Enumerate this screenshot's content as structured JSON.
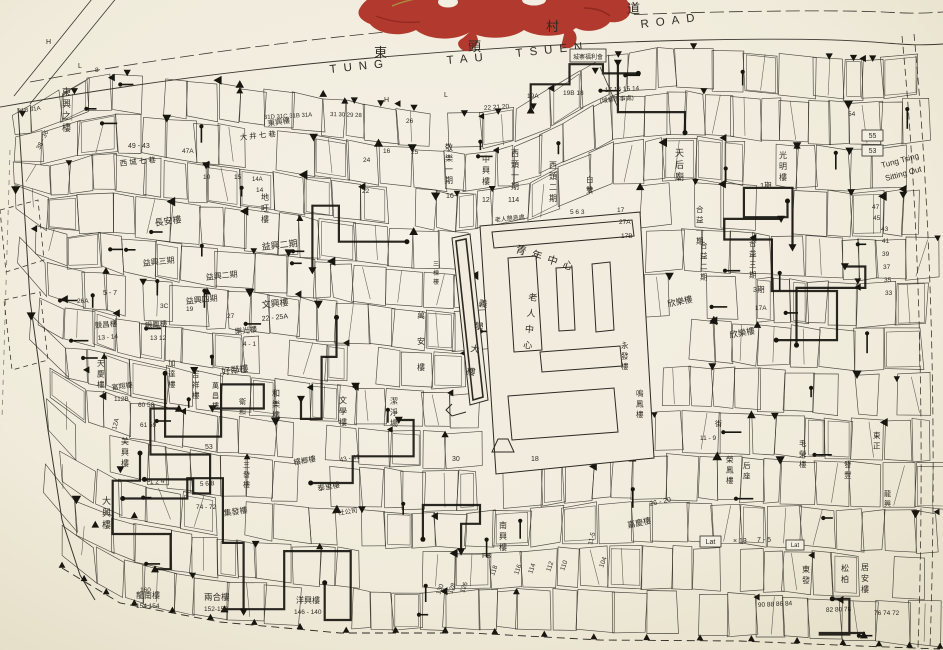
{
  "map": {
    "colors": {
      "paper": "#f2eee1",
      "paper_edge": "#e6dfca",
      "ink": "#2e2b24",
      "ink_heavy": "#17150f",
      "seal_red": "#b2392e",
      "seal_gold": "#a98f3e"
    },
    "road": {
      "name_zh": "東頭村道",
      "name_en": "TUNG TAU TSUEN ROAD",
      "zh": [
        {
          "t": "東",
          "x": 374,
          "y": 57
        },
        {
          "t": "頭",
          "x": 468,
          "y": 51
        },
        {
          "t": "村",
          "x": 546,
          "y": 31
        },
        {
          "t": "道",
          "x": 627,
          "y": 13
        }
      ],
      "en": [
        {
          "t": "TUNG",
          "x": 330,
          "y": 73,
          "rot": -6,
          "ls": 7
        },
        {
          "t": "TAU",
          "x": 447,
          "y": 64,
          "rot": -5,
          "ls": 7
        },
        {
          "t": "TSUEN",
          "x": 516,
          "y": 57,
          "rot": -6,
          "ls": 7
        },
        {
          "t": "ROAD",
          "x": 641,
          "y": 28,
          "rot": -7,
          "ls": 7
        }
      ]
    },
    "corner_note": {
      "line1": "Tung Tsing",
      "line2": "Sitting Out"
    },
    "boxes": [
      {
        "t": "城寨福利會",
        "x": 570,
        "y": 49,
        "w": 36,
        "h": 13,
        "fs": 6
      },
      {
        "t": "55",
        "x": 862,
        "y": 130,
        "w": 21,
        "h": 11,
        "fs": 7
      },
      {
        "t": "53",
        "x": 862,
        "y": 145,
        "w": 21,
        "h": 11,
        "fs": 7
      },
      {
        "t": "Lat",
        "x": 700,
        "y": 536,
        "w": 21,
        "h": 11,
        "fs": 7
      },
      {
        "t": "Lat",
        "x": 786,
        "y": 540,
        "w": 18,
        "h": 10,
        "fs": 6
      }
    ],
    "labels": [
      {
        "t": "東興之樓",
        "x": 62,
        "y": 95,
        "fs": 9,
        "v": 1
      },
      {
        "t": "長安樓",
        "x": 155,
        "y": 226,
        "fs": 9,
        "rot": -8
      },
      {
        "t": "地旺樓",
        "x": 261,
        "y": 200,
        "fs": 8,
        "v": 1
      },
      {
        "t": "益興二期",
        "x": 262,
        "y": 250,
        "fs": 9,
        "rot": -6
      },
      {
        "t": "益興三期",
        "x": 143,
        "y": 266,
        "fs": 8,
        "rot": -6
      },
      {
        "t": "益興二期",
        "x": 206,
        "y": 280,
        "fs": 8,
        "rot": -6
      },
      {
        "t": "益興四期",
        "x": 186,
        "y": 304,
        "fs": 8,
        "rot": -6
      },
      {
        "t": "文興樓",
        "x": 262,
        "y": 308,
        "fs": 9,
        "rot": -6
      },
      {
        "t": "22 - 25A",
        "x": 262,
        "y": 321,
        "fs": 7,
        "rot": -6,
        "n": 1
      },
      {
        "t": "競昌樓",
        "x": 95,
        "y": 328,
        "fs": 7.5,
        "rot": -5
      },
      {
        "t": "13 - 14",
        "x": 98,
        "y": 340,
        "fs": 6.5,
        "rot": -5,
        "n": 1
      },
      {
        "t": "銀鳳樓",
        "x": 145,
        "y": 328,
        "fs": 7.5,
        "rot": -5
      },
      {
        "t": "13  12",
        "x": 150,
        "y": 340,
        "fs": 6.5,
        "n": 1
      },
      {
        "t": "樂光樓",
        "x": 235,
        "y": 334,
        "fs": 7.5,
        "rot": -6
      },
      {
        "t": "4 - 1",
        "x": 243,
        "y": 346,
        "fs": 6.5,
        "n": 1
      },
      {
        "t": "好鄰樓",
        "x": 222,
        "y": 375,
        "fs": 9,
        "rot": -8
      },
      {
        "t": "萬昌樓",
        "x": 212,
        "y": 388,
        "fs": 7,
        "v": 1
      },
      {
        "t": "衛和",
        "x": 239,
        "y": 404,
        "fs": 7,
        "v": 1
      },
      {
        "t": "和樂樓",
        "x": 272,
        "y": 396,
        "fs": 8,
        "v": 1
      },
      {
        "t": "文學樓",
        "x": 339,
        "y": 403,
        "fs": 8,
        "v": 1
      },
      {
        "t": "萬安樓",
        "x": 417,
        "y": 318,
        "fs": 8,
        "v": 1,
        "vs": 26
      },
      {
        "t": "義學大樓",
        "x": 478,
        "y": 306,
        "fs": 9,
        "v": 1,
        "vs": 23,
        "rot": 10
      },
      {
        "t": "三棟樓",
        "x": 433,
        "y": 266,
        "fs": 6,
        "v": 1
      },
      {
        "t": "潔淨場",
        "x": 390,
        "y": 404,
        "fs": 8,
        "v": 1
      },
      {
        "t": "青年中心",
        "x": 515,
        "y": 252,
        "fs": 10.5,
        "rot": 18,
        "ls": 6
      },
      {
        "t": "老人中心",
        "x": 528,
        "y": 300,
        "fs": 9,
        "v": 1,
        "vs": 16,
        "rot": 6
      },
      {
        "t": "老人憩息處",
        "x": 495,
        "y": 222,
        "fs": 6,
        "rot": -6
      },
      {
        "t": "天后廟",
        "x": 675,
        "y": 156,
        "fs": 9,
        "v": 1
      },
      {
        "t": "合益一期",
        "x": 696,
        "y": 212,
        "fs": 7.5,
        "v": 1
      },
      {
        "t": "合益二期",
        "x": 700,
        "y": 248,
        "fs": 7.5,
        "v": 1
      },
      {
        "t": "合益三期",
        "x": 749,
        "y": 246,
        "fs": 7.5,
        "v": 1
      },
      {
        "t": "1期",
        "x": 760,
        "y": 188,
        "fs": 7.5
      },
      {
        "t": "3期",
        "x": 753,
        "y": 292,
        "fs": 7.5
      },
      {
        "t": "17A",
        "x": 755,
        "y": 310,
        "fs": 6.5,
        "n": 1
      },
      {
        "t": "欣樂樓",
        "x": 668,
        "y": 307,
        "fs": 8.5,
        "rot": -12
      },
      {
        "t": "欣樂樓",
        "x": 730,
        "y": 338,
        "fs": 8.5,
        "rot": -10
      },
      {
        "t": "光明樓",
        "x": 779,
        "y": 158,
        "fs": 8,
        "v": 1
      },
      {
        "t": "白雙",
        "x": 586,
        "y": 182,
        "fs": 7.5,
        "v": 1
      },
      {
        "t": "敬樂一期",
        "x": 445,
        "y": 150,
        "fs": 8,
        "v": 1
      },
      {
        "t": "16",
        "x": 446,
        "y": 198,
        "fs": 7,
        "n": 1
      },
      {
        "t": "中興樓",
        "x": 482,
        "y": 162,
        "fs": 8,
        "v": 1
      },
      {
        "t": "12",
        "x": 482,
        "y": 202,
        "fs": 7,
        "n": 1
      },
      {
        "t": "西頭一期",
        "x": 511,
        "y": 156,
        "fs": 8,
        "v": 1
      },
      {
        "t": "114",
        "x": 508,
        "y": 202,
        "fs": 7,
        "n": 1
      },
      {
        "t": "西頭二期",
        "x": 549,
        "y": 168,
        "fs": 8,
        "v": 1
      },
      {
        "t": "鳴鳳樓",
        "x": 636,
        "y": 396,
        "fs": 7.5,
        "v": 1
      },
      {
        "t": "永發樓",
        "x": 621,
        "y": 348,
        "fs": 7.5,
        "v": 1
      },
      {
        "t": "嘉慶樓",
        "x": 628,
        "y": 528,
        "fs": 8,
        "rot": -12
      },
      {
        "t": "26 - 20",
        "x": 650,
        "y": 506,
        "fs": 7,
        "rot": -12,
        "n": 1
      },
      {
        "t": "榮鳳樓",
        "x": 726,
        "y": 462,
        "fs": 7.5,
        "v": 1
      },
      {
        "t": "后座",
        "x": 743,
        "y": 468,
        "fs": 7.5,
        "v": 1
      },
      {
        "t": "毛榮樓",
        "x": 799,
        "y": 446,
        "fs": 7.5,
        "v": 1
      },
      {
        "t": "發豐",
        "x": 844,
        "y": 467,
        "fs": 7.5,
        "v": 1
      },
      {
        "t": "龍興",
        "x": 884,
        "y": 496,
        "fs": 7,
        "v": 1
      },
      {
        "t": "東正",
        "x": 873,
        "y": 438,
        "fs": 7.5,
        "v": 1
      },
      {
        "t": "東發",
        "x": 802,
        "y": 572,
        "fs": 8,
        "v": 1
      },
      {
        "t": "松柏",
        "x": 841,
        "y": 571,
        "fs": 8,
        "v": 1
      },
      {
        "t": "居安樓",
        "x": 861,
        "y": 570,
        "fs": 8,
        "v": 1
      },
      {
        "t": "大興樓",
        "x": 102,
        "y": 504,
        "fs": 9,
        "v": 1
      },
      {
        "t": "美興樓",
        "x": 121,
        "y": 444,
        "fs": 8,
        "v": 1
      },
      {
        "t": "三發樓",
        "x": 243,
        "y": 467,
        "fs": 7,
        "v": 1
      },
      {
        "t": "檳榔樓",
        "x": 294,
        "y": 465,
        "fs": 7.5,
        "rot": -10
      },
      {
        "t": "43 - 41",
        "x": 340,
        "y": 462,
        "fs": 6.5,
        "rot": -10,
        "n": 1
      },
      {
        "t": "泰里樓",
        "x": 318,
        "y": 491,
        "fs": 7.5,
        "rot": -10
      },
      {
        "t": "集發樓",
        "x": 224,
        "y": 516,
        "fs": 8,
        "rot": -8
      },
      {
        "t": "一社公司",
        "x": 332,
        "y": 516,
        "fs": 6.5,
        "rot": -8
      },
      {
        "t": "龍南樓",
        "x": 136,
        "y": 598,
        "fs": 8
      },
      {
        "t": "154  154",
        "x": 136,
        "y": 608,
        "fs": 6.5,
        "n": 1
      },
      {
        "t": "兩合樓",
        "x": 204,
        "y": 600,
        "fs": 8.5
      },
      {
        "t": "152-150",
        "x": 204,
        "y": 611,
        "fs": 6.5,
        "n": 1
      },
      {
        "t": "洋興樓",
        "x": 296,
        "y": 603,
        "fs": 8
      },
      {
        "t": "146 - 140",
        "x": 294,
        "y": 614,
        "fs": 6.5,
        "n": 1
      },
      {
        "t": "南興樓",
        "x": 499,
        "y": 528,
        "fs": 8,
        "v": 1
      },
      {
        "t": "Tung Tsing",
        "x": 882,
        "y": 168,
        "fs": 8,
        "rot": -15
      },
      {
        "t": "Sitting Out",
        "x": 886,
        "y": 181,
        "fs": 8,
        "rot": -15
      },
      {
        "t": "東興樓",
        "x": 268,
        "y": 126,
        "fs": 7.5,
        "rot": -8
      },
      {
        "t": "大 井 七 巷",
        "x": 240,
        "y": 140,
        "fs": 7.5,
        "rot": -6
      },
      {
        "t": "西 城 七 巷",
        "x": 120,
        "y": 166,
        "fs": 7.5,
        "rot": -6
      },
      {
        "t": "49 - 43",
        "x": 128,
        "y": 148,
        "fs": 7,
        "n": 1
      },
      {
        "t": "47A",
        "x": 182,
        "y": 153,
        "fs": 6.5,
        "n": 1
      },
      {
        "t": "5 - 7",
        "x": 103,
        "y": 295,
        "fs": 7,
        "n": 1
      },
      {
        "t": "26A",
        "x": 77,
        "y": 303,
        "fs": 6.5,
        "n": 1
      },
      {
        "t": "3C",
        "x": 160,
        "y": 308,
        "fs": 6.5,
        "n": 1
      },
      {
        "t": "19",
        "x": 186,
        "y": 311,
        "fs": 6.5,
        "n": 1
      },
      {
        "t": "27",
        "x": 227,
        "y": 318,
        "fs": 6.5,
        "n": 1
      },
      {
        "t": "天慶樓",
        "x": 97,
        "y": 366,
        "fs": 7.5,
        "v": 1
      },
      {
        "t": "富翔樓",
        "x": 112,
        "y": 390,
        "fs": 7,
        "rot": -8
      },
      {
        "t": "112B",
        "x": 114,
        "y": 401,
        "fs": 6.5,
        "n": 1
      },
      {
        "t": "加達樓",
        "x": 168,
        "y": 366,
        "fs": 7.5,
        "v": 1
      },
      {
        "t": "吉祥樓",
        "x": 192,
        "y": 377,
        "fs": 7.5,
        "v": 1
      },
      {
        "t": "60  58",
        "x": 138,
        "y": 407,
        "fs": 6.5,
        "n": 1
      },
      {
        "t": "61  59",
        "x": 140,
        "y": 427,
        "fs": 6.5,
        "n": 1
      },
      {
        "t": "12A",
        "x": 116,
        "y": 430,
        "fs": 6.5,
        "rot": -75,
        "n": 1
      },
      {
        "t": "38 - 36",
        "x": 40,
        "y": 150,
        "fs": 6.5,
        "rot": -65,
        "n": 1
      },
      {
        "t": "31B 31A",
        "x": 18,
        "y": 113,
        "fs": 6,
        "rot": -8,
        "n": 1
      },
      {
        "t": "街",
        "x": 715,
        "y": 426,
        "fs": 7
      },
      {
        "t": "11 - 9",
        "x": 700,
        "y": 440,
        "fs": 6.5,
        "n": 1
      },
      {
        "t": "× 13",
        "x": 733,
        "y": 543,
        "fs": 7,
        "n": 1
      },
      {
        "t": "7 - 5",
        "x": 757,
        "y": 542,
        "fs": 7,
        "n": 1
      },
      {
        "t": "90 88 86 84",
        "x": 758,
        "y": 607,
        "fs": 6.5,
        "rot": -3,
        "n": 1
      },
      {
        "t": "82 80 78",
        "x": 826,
        "y": 612,
        "fs": 6.5,
        "rot": -2,
        "n": 1
      },
      {
        "t": "76 74 72",
        "x": 874,
        "y": 615,
        "fs": 6.5,
        "n": 1
      },
      {
        "t": "54",
        "x": 848,
        "y": 116,
        "fs": 6.5,
        "n": 1
      },
      {
        "t": "47",
        "x": 872,
        "y": 209,
        "fs": 6.5,
        "n": 1
      },
      {
        "t": "45",
        "x": 873,
        "y": 220,
        "fs": 6.5,
        "n": 1
      },
      {
        "t": "43",
        "x": 881,
        "y": 231,
        "fs": 6.5,
        "n": 1
      },
      {
        "t": "41",
        "x": 882,
        "y": 243,
        "fs": 6.5,
        "n": 1
      },
      {
        "t": "39",
        "x": 882,
        "y": 256,
        "fs": 6.5,
        "n": 1
      },
      {
        "t": "37",
        "x": 883,
        "y": 269,
        "fs": 6.5,
        "n": 1
      },
      {
        "t": "35",
        "x": 884,
        "y": 282,
        "fs": 6.5,
        "n": 1
      },
      {
        "t": "33",
        "x": 885,
        "y": 295,
        "fs": 6.5,
        "n": 1
      },
      {
        "t": "19A",
        "x": 527,
        "y": 98,
        "fs": 6.5,
        "n": 1
      },
      {
        "t": "19B 18",
        "x": 563,
        "y": 95,
        "fs": 6.5,
        "n": 1
      },
      {
        "t": "17 16 15 14",
        "x": 605,
        "y": 92,
        "fs": 6.5,
        "rot": -3,
        "n": 1
      },
      {
        "t": "(城寨辦事處)",
        "x": 600,
        "y": 103,
        "fs": 6,
        "rot": -6
      },
      {
        "t": "22 21 20",
        "x": 484,
        "y": 110,
        "fs": 6.5,
        "rot": -4,
        "n": 1
      },
      {
        "t": "31D 31C 31B 31A",
        "x": 264,
        "y": 119,
        "fs": 6,
        "rot": -3,
        "n": 1
      },
      {
        "t": "31 30 29 28",
        "x": 330,
        "y": 116,
        "fs": 6,
        "rot": 2,
        "n": 1
      },
      {
        "t": "26",
        "x": 406,
        "y": 123,
        "fs": 6.5,
        "n": 1
      },
      {
        "t": "25",
        "x": 411,
        "y": 154,
        "fs": 6.5,
        "n": 1
      },
      {
        "t": "24",
        "x": 363,
        "y": 162,
        "fs": 6.5,
        "n": 1
      },
      {
        "t": "16",
        "x": 383,
        "y": 153,
        "fs": 6.5,
        "n": 1
      },
      {
        "t": "22",
        "x": 362,
        "y": 193,
        "fs": 6.5,
        "n": 1
      },
      {
        "t": "10",
        "x": 203,
        "y": 179,
        "fs": 6.5,
        "n": 1
      },
      {
        "t": "15",
        "x": 234,
        "y": 179,
        "fs": 6.5,
        "n": 1
      },
      {
        "t": "14A",
        "x": 252,
        "y": 181,
        "fs": 6,
        "n": 1
      },
      {
        "t": "14",
        "x": 256,
        "y": 192,
        "fs": 6.5,
        "n": 1
      },
      {
        "t": "17",
        "x": 617,
        "y": 212,
        "fs": 6.5,
        "n": 1
      },
      {
        "t": "27A",
        "x": 619,
        "y": 224,
        "fs": 6.5,
        "n": 1
      },
      {
        "t": "17B",
        "x": 621,
        "y": 238,
        "fs": 6.5,
        "n": 1
      },
      {
        "t": "5 6 3",
        "x": 570,
        "y": 214,
        "fs": 6.5,
        "n": 1
      },
      {
        "t": "18",
        "x": 531,
        "y": 461,
        "fs": 7,
        "n": 1
      },
      {
        "t": "30",
        "x": 452,
        "y": 461,
        "fs": 7,
        "n": 1
      },
      {
        "t": "FB",
        "x": 482,
        "y": 558,
        "fs": 7,
        "n": 1
      },
      {
        "t": "11-5",
        "x": 592,
        "y": 545,
        "fs": 6.5,
        "rot": -75,
        "n": 1
      },
      {
        "t": "118",
        "x": 494,
        "y": 576,
        "fs": 6.5,
        "rot": -70,
        "n": 1
      },
      {
        "t": "116",
        "x": 518,
        "y": 575,
        "fs": 6.5,
        "rot": -70,
        "n": 1
      },
      {
        "t": "114",
        "x": 532,
        "y": 574,
        "fs": 6.5,
        "rot": -70,
        "n": 1
      },
      {
        "t": "112",
        "x": 550,
        "y": 572,
        "fs": 6.5,
        "rot": -70,
        "n": 1
      },
      {
        "t": "110",
        "x": 564,
        "y": 571,
        "fs": 6.5,
        "rot": -70,
        "n": 1
      },
      {
        "t": "104",
        "x": 603,
        "y": 568,
        "fs": 6.5,
        "rot": -70,
        "n": 1
      },
      {
        "t": "130",
        "x": 440,
        "y": 595,
        "fs": 6.5,
        "rot": -70,
        "n": 1
      },
      {
        "t": "128",
        "x": 452,
        "y": 594,
        "fs": 6.5,
        "rot": -70,
        "n": 1
      },
      {
        "t": "126",
        "x": 464,
        "y": 593,
        "fs": 6.5,
        "rot": -70,
        "n": 1
      },
      {
        "t": "160",
        "x": 140,
        "y": 592,
        "fs": 6.5,
        "n": 1
      },
      {
        "t": "53",
        "x": 205,
        "y": 449,
        "fs": 7,
        "n": 1
      },
      {
        "t": "74 - 72",
        "x": 196,
        "y": 509,
        "fs": 6.5,
        "n": 1
      },
      {
        "t": "1  2  4",
        "x": 150,
        "y": 484,
        "fs": 6.5,
        "rot": -4,
        "n": 1
      },
      {
        "t": "5  6  8",
        "x": 200,
        "y": 486,
        "fs": 6.5,
        "rot": -3,
        "n": 1
      },
      {
        "t": "8",
        "x": 95,
        "y": 72,
        "fs": 6.5,
        "n": 1
      },
      {
        "t": "H",
        "x": 46,
        "y": 44,
        "fs": 7
      },
      {
        "t": "H",
        "x": 384,
        "y": 102,
        "fs": 7
      },
      {
        "t": "L",
        "x": 444,
        "y": 97,
        "fs": 7
      },
      {
        "t": "L",
        "x": 78,
        "y": 68,
        "fs": 7
      }
    ]
  }
}
